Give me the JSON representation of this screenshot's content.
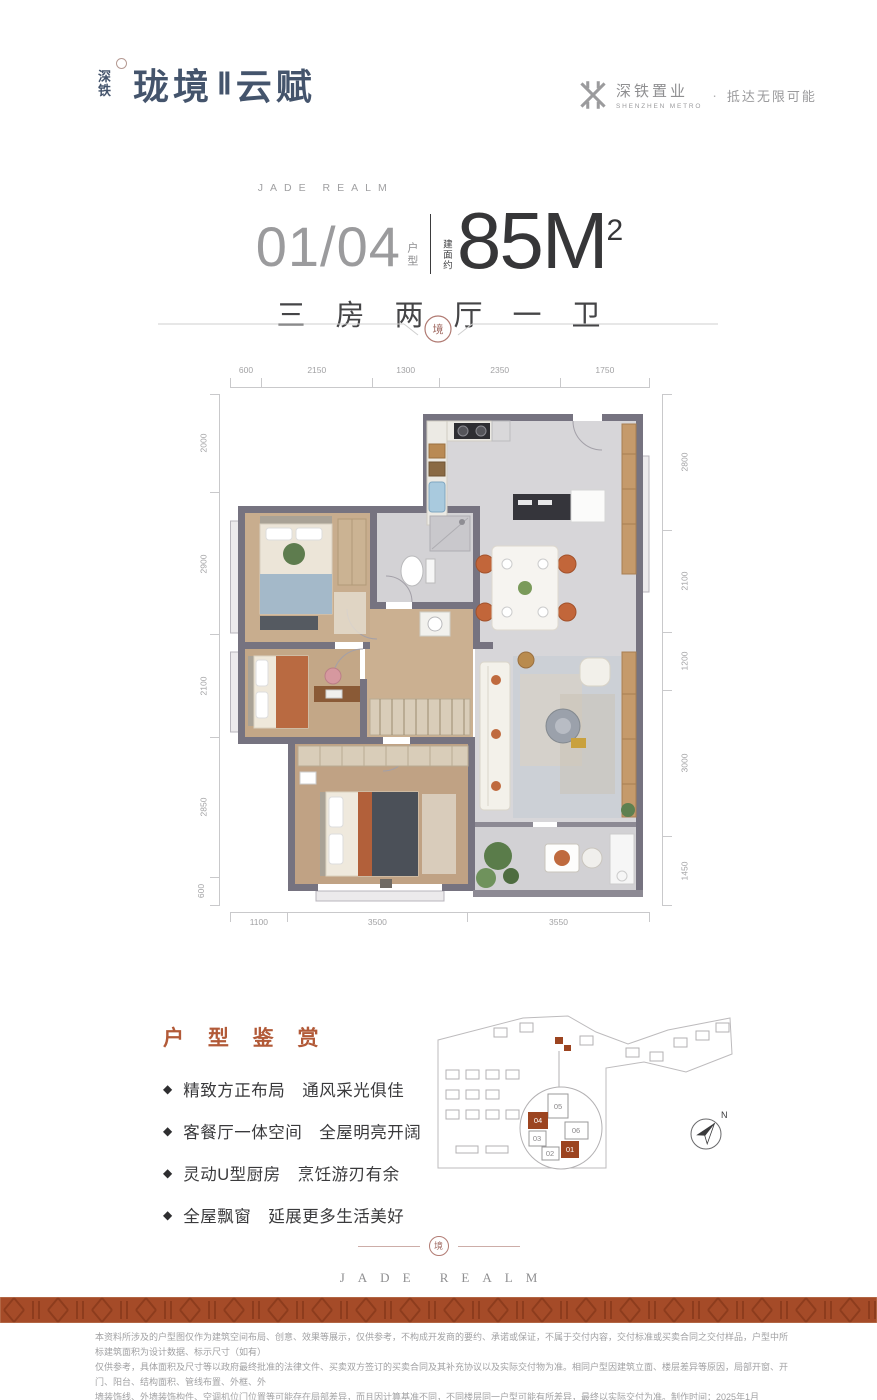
{
  "colors": {
    "brand_blue": "#44546c",
    "accent_orange": "#b25a38",
    "footer_band": "#a54b28",
    "wall_gray": "#767380",
    "highlight_brown": "#9c4420"
  },
  "header": {
    "logo_prefix_top": "深",
    "logo_prefix_bottom": "铁",
    "logo_main": "珑境",
    "logo_numeral": "Ⅱ",
    "logo_suffix": "云赋",
    "metro_name": "深铁置业",
    "metro_sub": "SHENZHEN METRO",
    "separator_dot": "·",
    "metro_slogan": "抵达无限可能"
  },
  "headline": {
    "eyebrow": "JADE REALM",
    "unit_number": "01/04",
    "unit_label": "户型",
    "area_prefix": "建面约",
    "area_value": "85M",
    "area_sup": "2",
    "rooms": "三房两厅一卫"
  },
  "divider": {
    "seal_char": "境"
  },
  "plan": {
    "dims_top": [
      "600",
      "2150",
      "1300",
      "2350",
      "1750"
    ],
    "dims_left": [
      "2000",
      "2900",
      "2100",
      "2850",
      "600"
    ],
    "dims_right": [
      "2800",
      "2100",
      "1200",
      "3000",
      "1450"
    ],
    "dims_bottom": [
      "1100",
      "3500",
      "3550"
    ]
  },
  "features": {
    "title": "户 型 鉴 赏",
    "bullet": "◆",
    "items": [
      "精致方正布局　通风采光俱佳",
      "客餐厅一体空间　全屋明亮开阔",
      "灵动U型厨房　烹饪游刃有余",
      "全屋飘窗　延展更多生活美好"
    ]
  },
  "siteplan": {
    "units": [
      "05",
      "04",
      "03",
      "06",
      "02",
      "01"
    ],
    "highlighted_units": [
      "04",
      "01"
    ],
    "compass_label": "N"
  },
  "brand_footer": {
    "seal_char": "境",
    "text": "JADE REALM"
  },
  "disclaimer": {
    "lines": [
      "本资料所涉及的户型图仅作为建筑空间布局、创意、效果等展示，仅供参考，不构成开发商的要约、承诺或保证，不属于交付内容，交付标准或买卖合同之交付样品，户型中所标建筑面积为设计数据、标示尺寸（如有）",
      "仅供参考，具体面积及尺寸等以政府最终批准的法律文件、买卖双方签订的买卖合同及其补充协议以及实际交付物为准。相同户型因建筑立面、楼层差异等原因，局部开窗、开门、阳台、结构面积、管线布置、外框、外",
      "墙装饰线、外墙装饰构件、空调机位门位置等可能存在局部差异，而且因计算基准不同，不同楼层同一户型可能有所差异，最终以实际交付为准。制作时间：2025年1月"
    ]
  }
}
